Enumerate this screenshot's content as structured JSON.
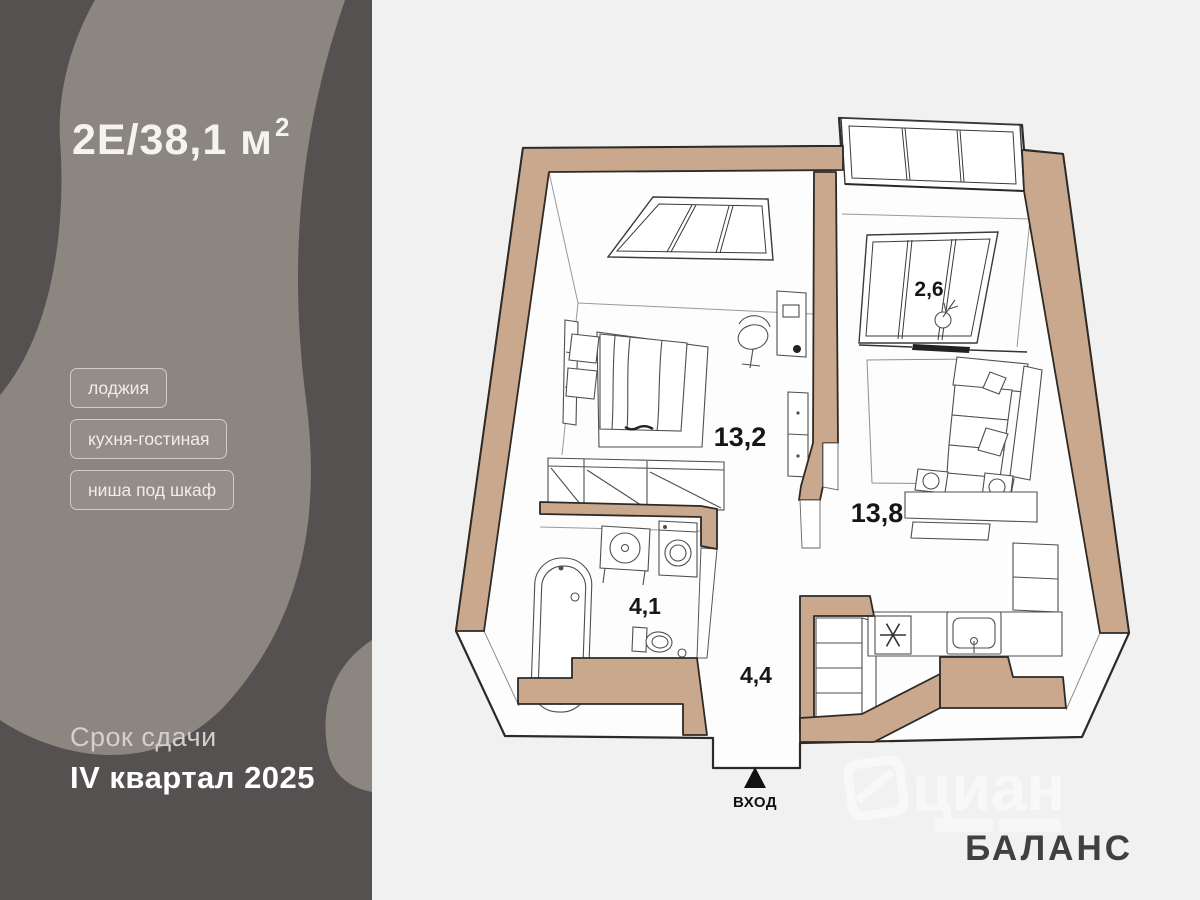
{
  "panel": {
    "title_main": "2Е/38,1 м",
    "title_sup": "2",
    "tags": [
      "лоджия",
      "кухня-гостиная",
      "ниша под шкаф"
    ],
    "deadline": {
      "label": "Срок сдачи",
      "value": "IV квартал 2025"
    },
    "colors": {
      "background": "#555150",
      "swirl": "#8C8680"
    }
  },
  "plan": {
    "rooms": {
      "bedroom": {
        "area": "13,2"
      },
      "kitchen_living": {
        "area": "13,8"
      },
      "loggia": {
        "area": "2,6"
      },
      "bathroom": {
        "area": "4,1"
      },
      "hallway": {
        "area": "4,4"
      }
    },
    "entrance_label": "ВХОД",
    "colors": {
      "wall": "#C9A88E",
      "outline": "#2D2A26",
      "interior": "#FDFDFD",
      "backdrop": "#F1F1F1"
    }
  },
  "branding": {
    "developer": "БАЛАНС",
    "watermark": "циан"
  }
}
